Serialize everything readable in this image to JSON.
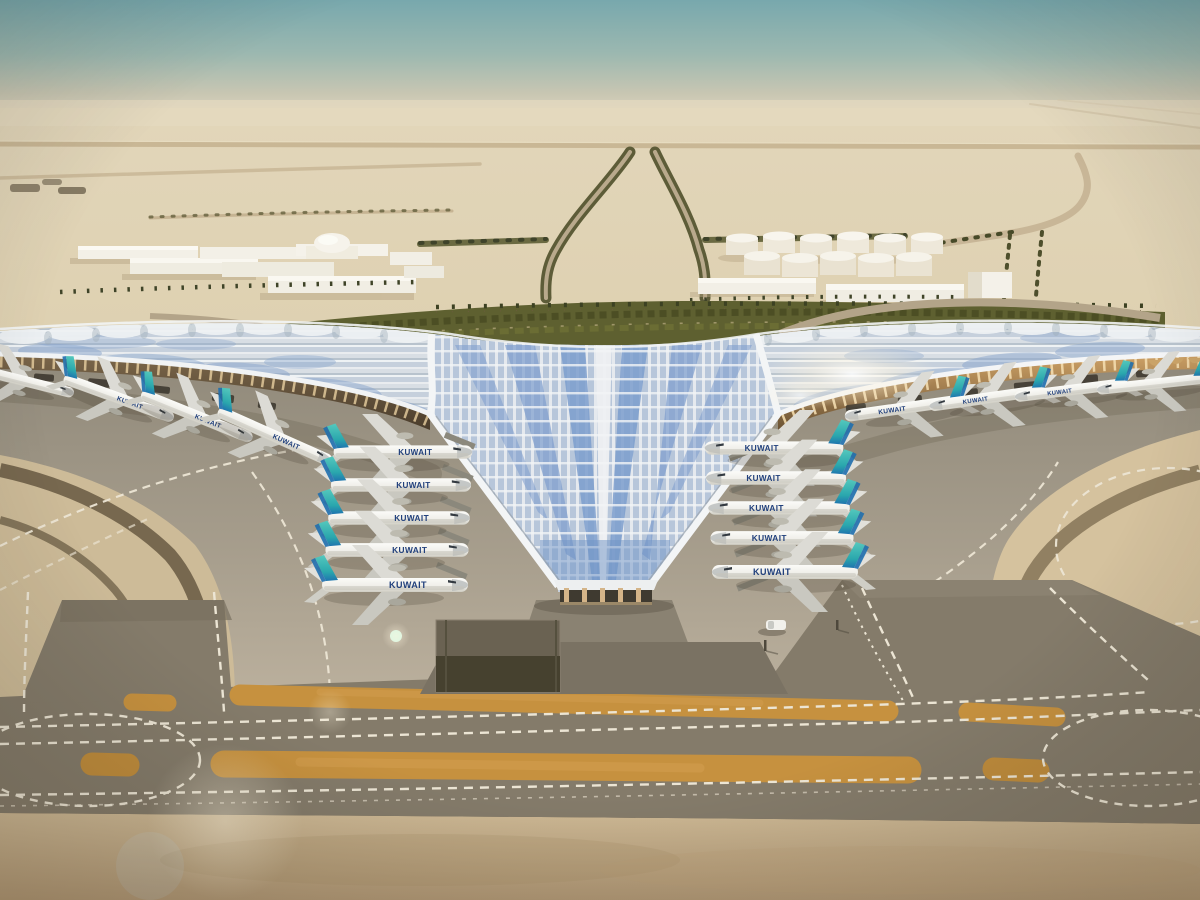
{
  "scene": {
    "airline_title": "KUWAIT",
    "palette": {
      "sky_top": "#7caaae",
      "sky_horizon": "#ded5c0",
      "desert_sand": "#ddcfae",
      "foreground_sand": "#c4ad8a",
      "apron_concrete": "#a59c8b",
      "taxiway_asphalt": "#857c6b",
      "marking_white": "#ece5d4",
      "marking_orange": "#c6913f",
      "roof_silver": "#dfe4e8",
      "roof_glass_blue": "#84a2cf",
      "aircraft_tail_teal": "#3ab6b0",
      "landscape_green": "#5e6030",
      "building_white": "#f3f0e7"
    }
  }
}
